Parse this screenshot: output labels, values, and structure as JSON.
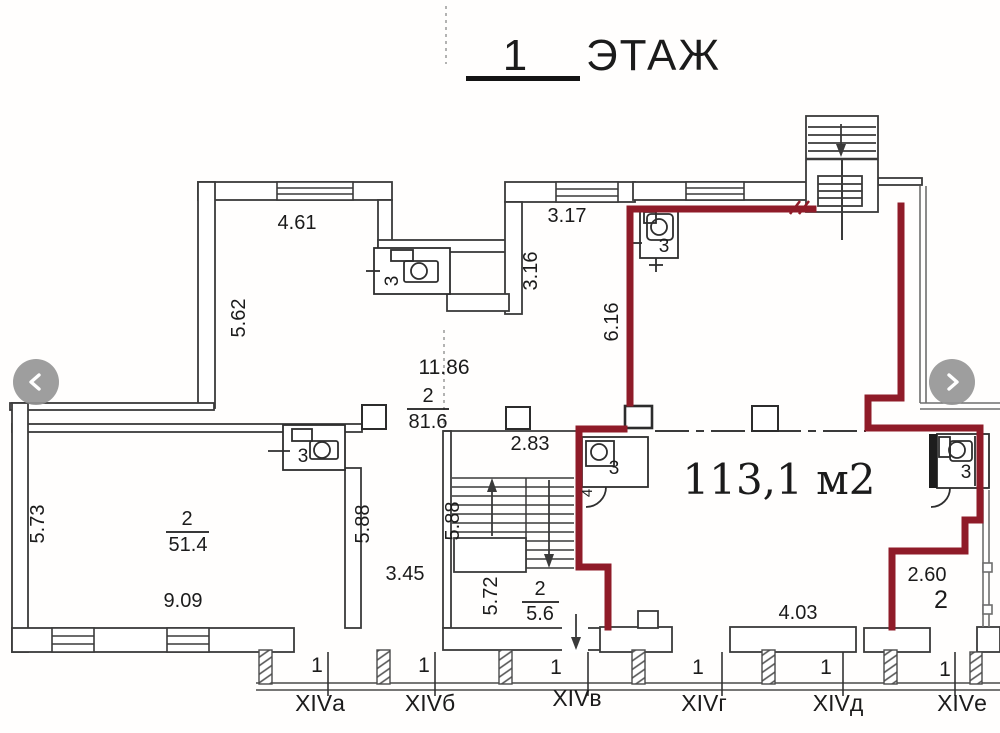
{
  "title": {
    "number": "1",
    "word": "ЭТАЖ"
  },
  "carousel": {
    "prev_icon": "chevron-left",
    "next_icon": "chevron-right"
  },
  "plan": {
    "area_label": "113,1 м2",
    "rooms": {
      "r816": {
        "num": "2",
        "area": "81.6"
      },
      "r514": {
        "num": "2",
        "area": "51.4"
      },
      "r56": {
        "num": "2",
        "area": "5.6"
      },
      "r260": {
        "num": "2"
      },
      "wc": "3",
      "wc_alt": "4"
    },
    "dims": {
      "d461": "4.61",
      "d562": "5.62",
      "d317": "3.17",
      "d316": "3.16",
      "d616": "6.16",
      "d1186": "11.86",
      "d283": "2.83",
      "d573": "5.73",
      "d588a": "5.88",
      "d588b": "5.88",
      "d909": "9.09",
      "d345": "3.45",
      "d572": "5.72",
      "d403": "4.03",
      "d260": "2.60"
    },
    "axis": {
      "units": [
        "1",
        "1",
        "1",
        "1",
        "1",
        "1"
      ],
      "labels": [
        "XIVа",
        "XIVб",
        "XIVв",
        "XIVг",
        "XIVд",
        "XIVе"
      ]
    }
  },
  "colors": {
    "highlight": "#8f1b28",
    "axis": "#c2506e",
    "wall": "#3a3a3a"
  }
}
